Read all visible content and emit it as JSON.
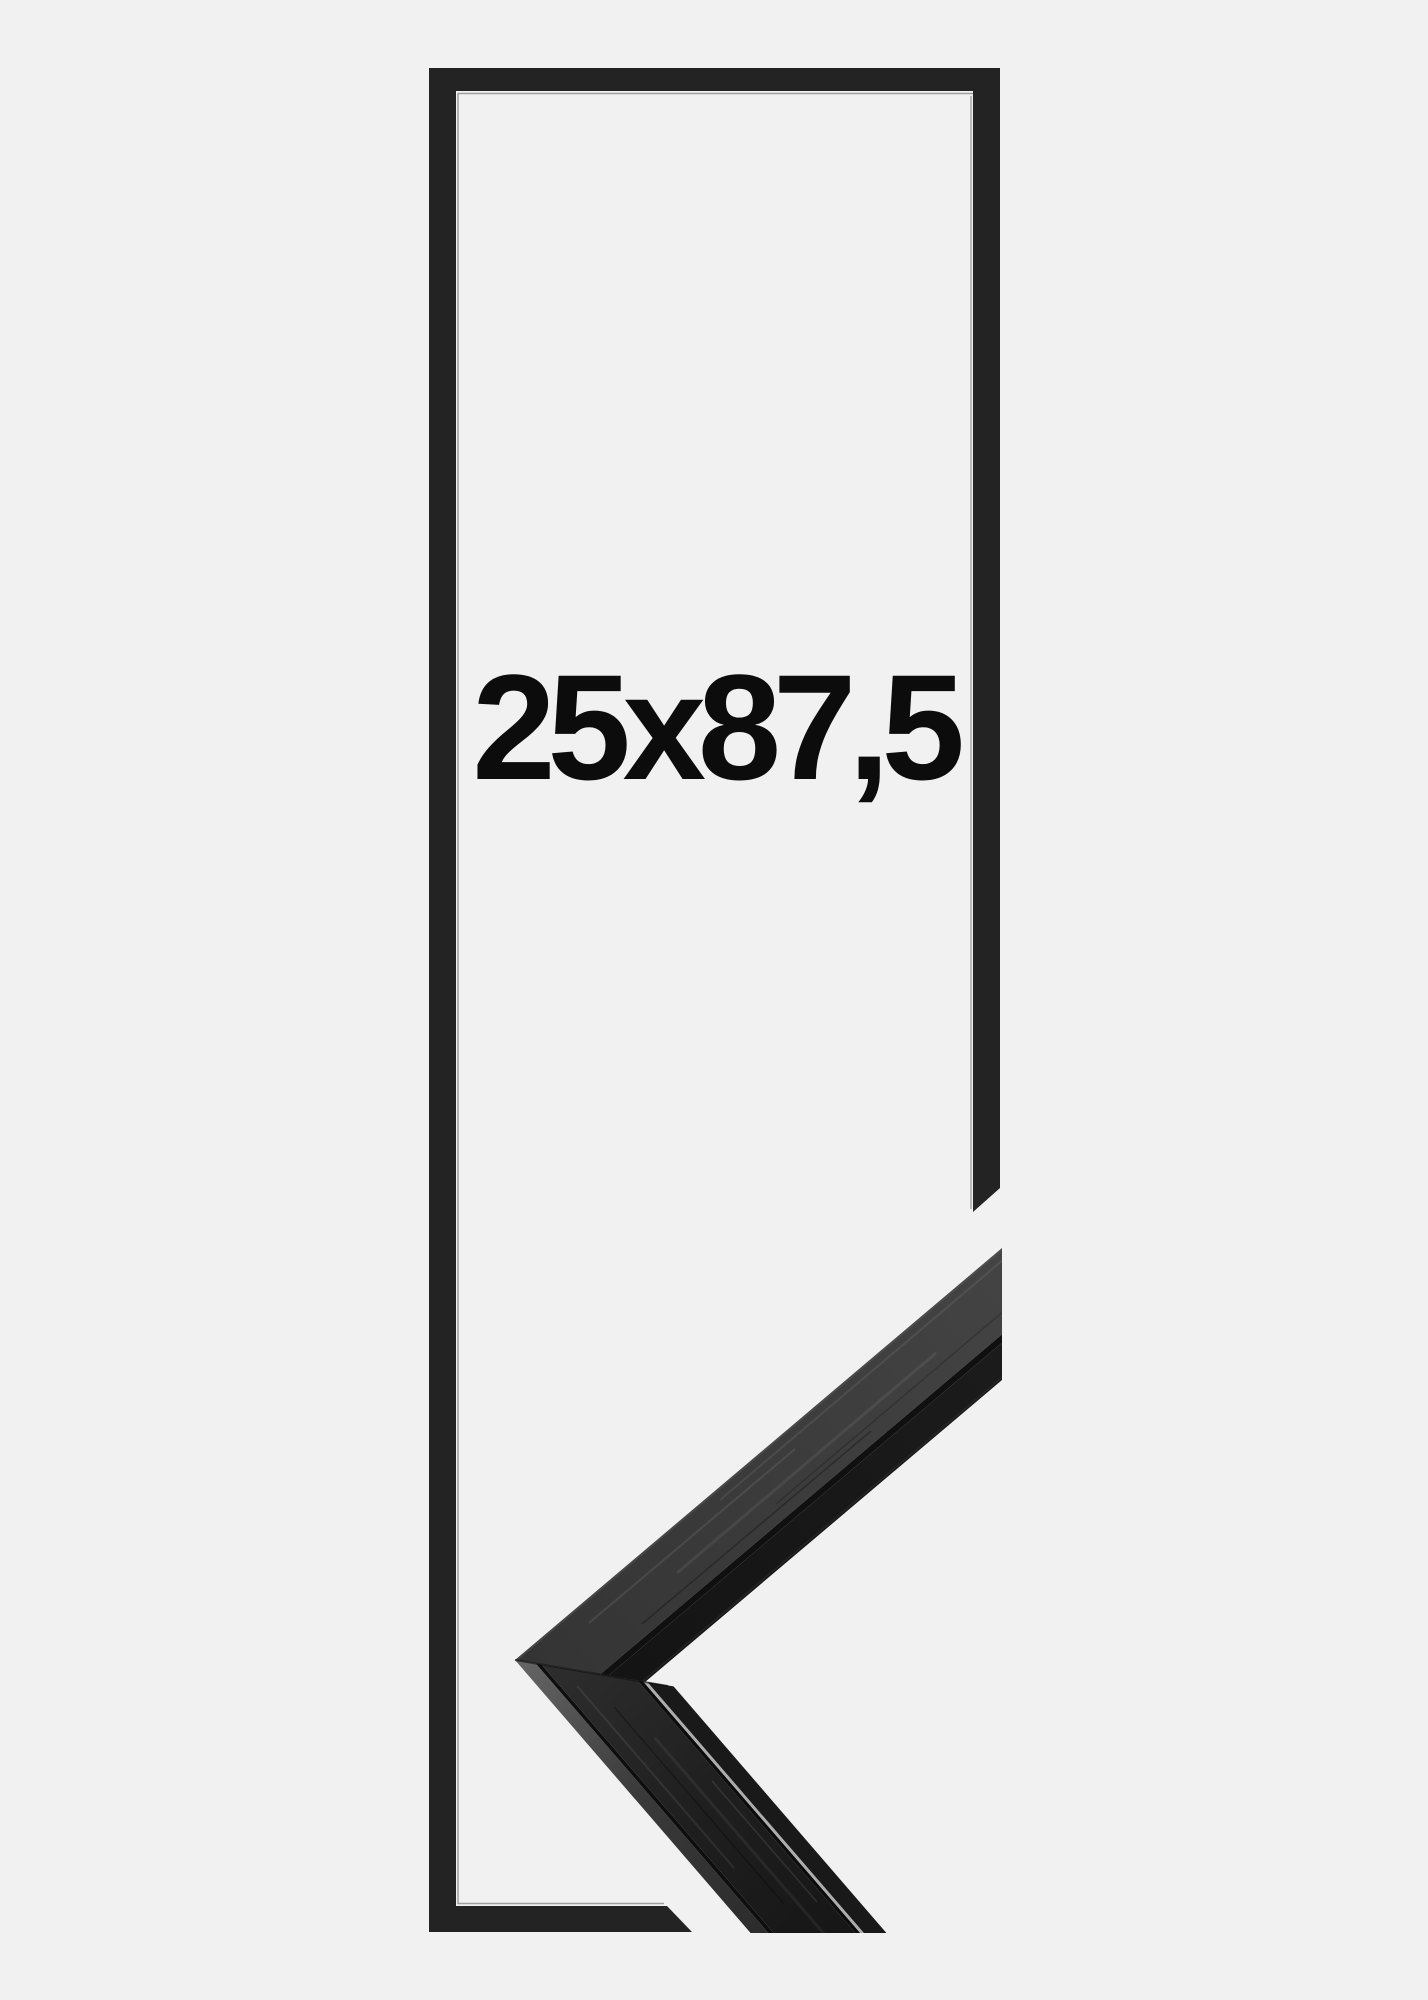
{
  "product": {
    "size_label": "25x87,5"
  },
  "colors": {
    "background": "#f1f1f2",
    "frame_black": "#232323",
    "label_text": "#0c0c0c",
    "moulding_face_upper": "#3d3d3d",
    "moulding_face_lower": "#1f1f1f",
    "moulding_lip": "#181818",
    "moulding_highlight": "#5f5f5f"
  }
}
